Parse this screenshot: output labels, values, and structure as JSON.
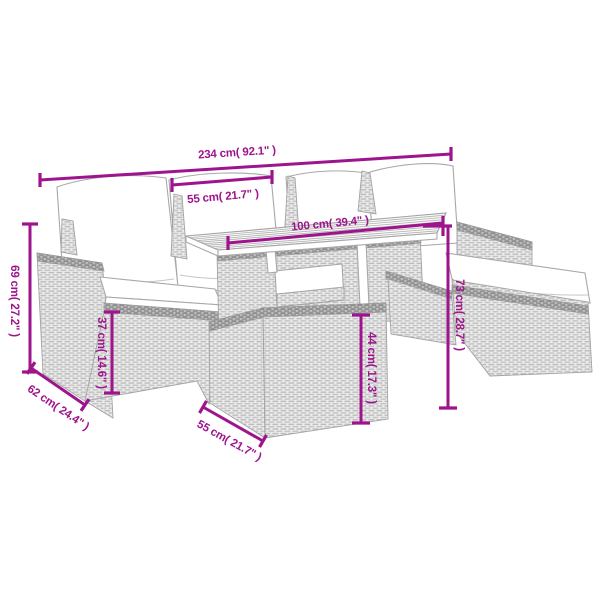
{
  "colors": {
    "dimension_accent": "#9E148C",
    "line_art": "#A8A8A8",
    "background": "#FFFFFF"
  },
  "diagram": {
    "dimensions": {
      "total_width": "234 cm( 92.1\" )",
      "seat_width": "55 cm( 21.7\" )",
      "table_top_width": "100 cm( 39.4\" )",
      "total_height": "69 cm( 27.2\" )",
      "seat_height": "37 cm( 14.6\" )",
      "seat_depth": "62 cm( 24.4\" )",
      "stool_width": "55 cm( 21.7\" )",
      "table_height": "44 cm( 17.3\" )",
      "back_height": "73 cm( 28.7\" )"
    }
  }
}
